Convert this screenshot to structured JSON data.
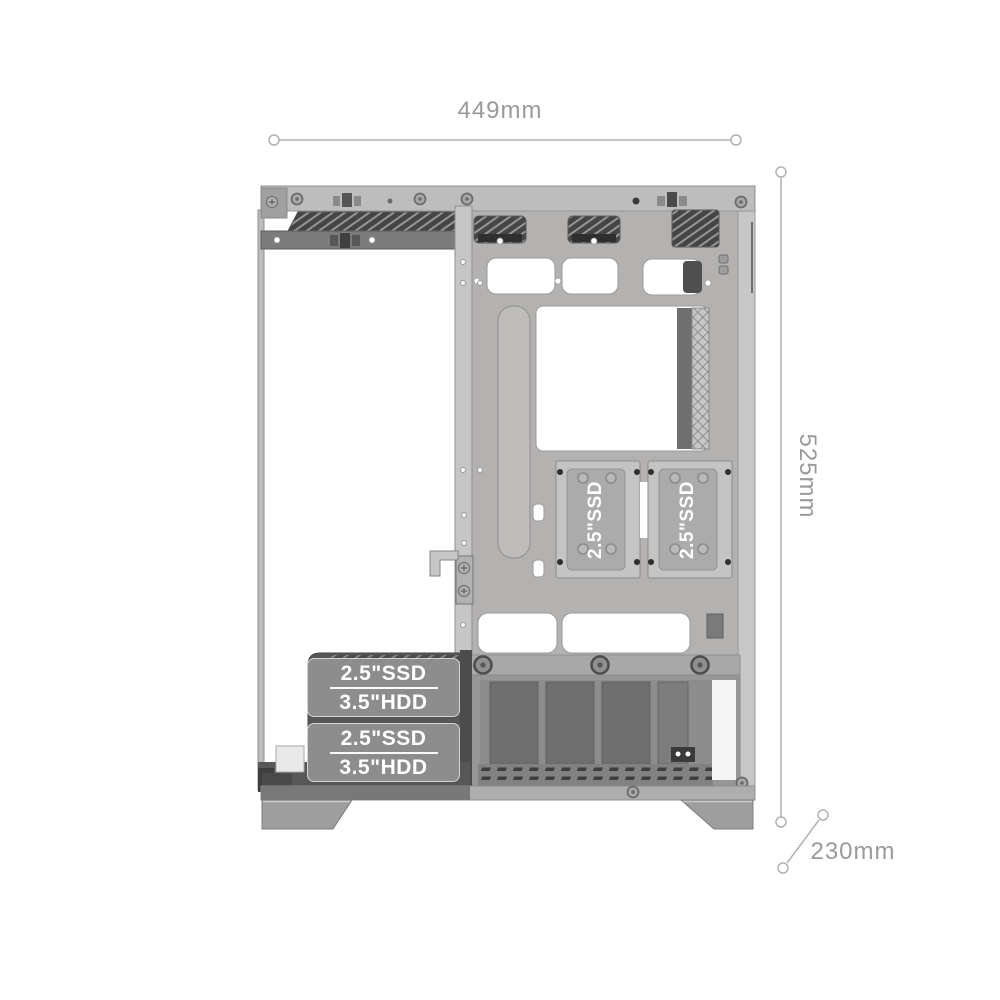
{
  "diagram": {
    "subject": "PC case chassis side-view dimension diagram",
    "dimensions": {
      "width_label": "449mm",
      "height_label": "525mm",
      "depth_label": "230mm"
    },
    "ssd_mounts": [
      {
        "label": "2.5\"SSD"
      },
      {
        "label": "2.5\"SSD"
      }
    ],
    "drive_bays": [
      {
        "ssd_label": "2.5\"SSD",
        "hdd_label": "3.5\"HDD"
      },
      {
        "ssd_label": "2.5\"SSD",
        "hdd_label": "3.5\"HDD"
      }
    ],
    "colors": {
      "background": "#ffffff",
      "dimension_text": "#9a9a9a",
      "dimension_line": "#b2b2b2",
      "label_text": "#ffffff",
      "label_overlay": "rgba(148,148,148,0.9)",
      "case_light": "#b5b3b1",
      "case_dark": "#454545"
    }
  }
}
